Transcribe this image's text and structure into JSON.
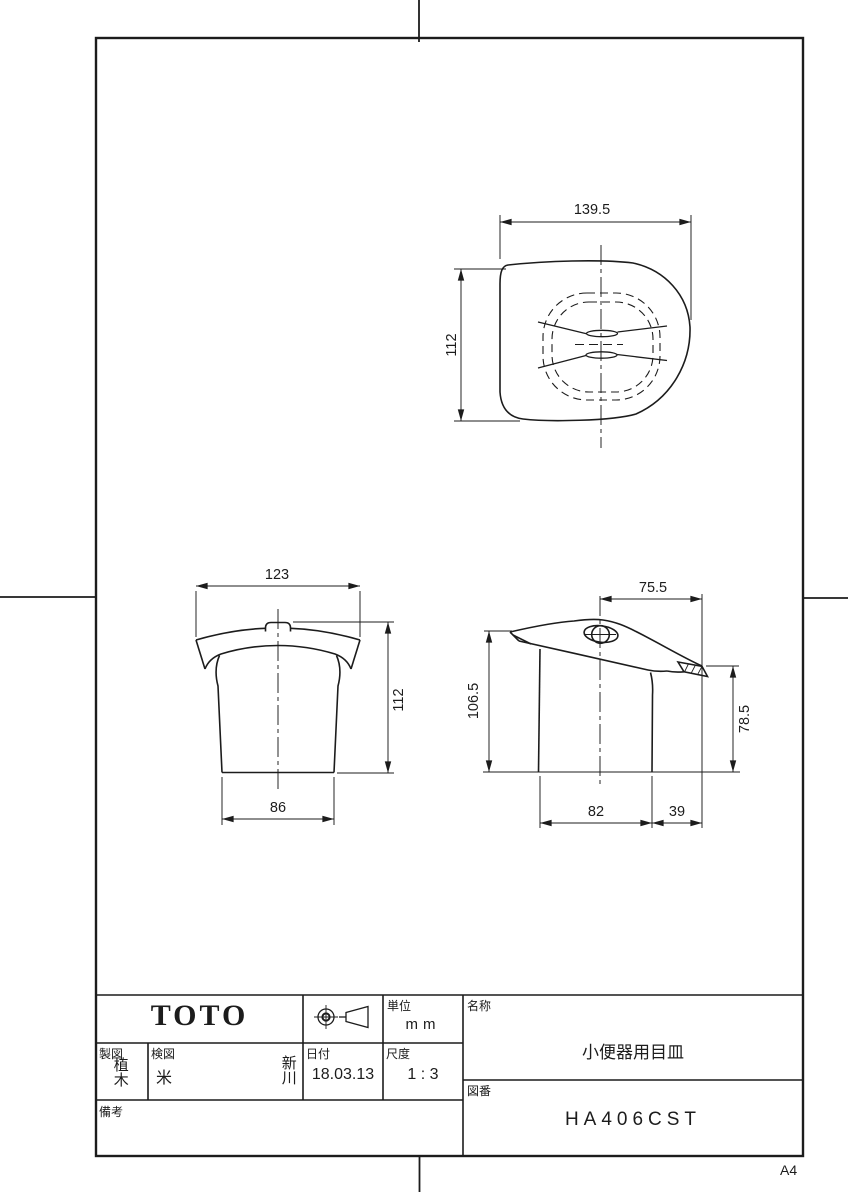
{
  "sheet": {
    "paper_size": "A4"
  },
  "drawing": {
    "top_view": {
      "width": "139.5",
      "height": "112"
    },
    "front_view": {
      "width": "123",
      "height": "112",
      "base_width": "86"
    },
    "side_view": {
      "top_offset": "75.5",
      "height_left": "106.5",
      "height_right": "78.5",
      "base_width": "82",
      "flange_overhang": "39"
    }
  },
  "title_block": {
    "logo": "TOTO",
    "unit": {
      "label": "単位",
      "value": "mm"
    },
    "drafter": {
      "label": "製図",
      "value": "植木"
    },
    "checker": {
      "label": "検図",
      "value1": "米",
      "value2": "新川"
    },
    "date": {
      "label": "日付",
      "value": "18.03.13"
    },
    "scale": {
      "label": "尺度",
      "value": "1 : 3"
    },
    "remarks": {
      "label": "備考",
      "value": ""
    },
    "name": {
      "label": "名称",
      "value": "小便器用目皿"
    },
    "drawing_no": {
      "label": "図番",
      "value": "HA406CST"
    }
  }
}
